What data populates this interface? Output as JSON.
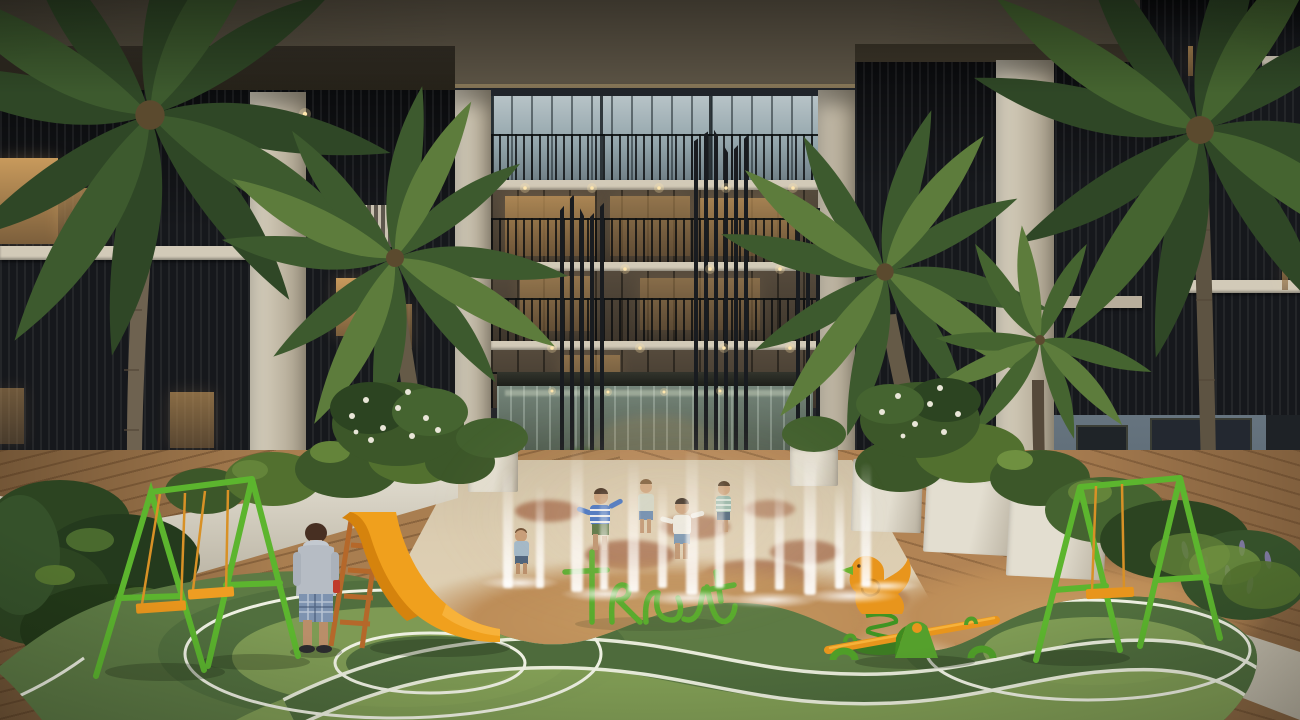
{
  "scene": {
    "description": "Dusk architectural rendering of a residential courtyard: a five-storey apartment building with glass balconies encloses a children's playground with splash-pad water jets, a glass pavilion entrance, palm trees, white planters with tropical plants, a green A-frame swing set with orange seats on each side, an orange slide with wooden ladder, a green tubular letter sculpture, an orange bird spring rider, an orange seesaw with green base, and a green rubber play surface with white curved lane lines over a timber deck.",
    "objects": [
      "apartment-building-facade",
      "glass-pavilion-entrance",
      "balcony-railings",
      "white-piers",
      "palm-trees",
      "splash-pad-water-jets",
      "children-playing",
      "child-walking",
      "swing-set-left",
      "swing-set-right",
      "orange-slide",
      "ladder",
      "letter-tube-sculpture",
      "bird-spring-rider",
      "seesaw",
      "green-play-surface",
      "white-lane-lines",
      "timber-deck",
      "white-planters",
      "tropical-plants",
      "frangipani-flowers",
      "rattan-chair",
      "downlights",
      "lit-windows"
    ],
    "people": {
      "children_in_splash_pad": 5,
      "child_walking": 1
    }
  },
  "colors": {
    "ceiling_a": "#4a4437",
    "ceiling_b": "#5d5546",
    "beam": "#7c6e52",
    "pier_light": "#ded7c5",
    "pier_shadow": "#a89e8a",
    "slab": "#d2cab8",
    "louver_bg": "#16181c",
    "louver_line": "#2e3136",
    "glass_light": "#b7c3c7",
    "glass_mid": "#93a5ab",
    "glass_dark": "#6f7f86",
    "mullion": "#30383d",
    "warm": "#c89a5c",
    "warm_dim": "#7c5f3c",
    "downlight": "#ffe6ad",
    "pavilion_top": "#23251f",
    "pavilion_glass_a": "#75857a",
    "pavilion_glass_b": "#3c4a40",
    "deck": "#a97e50",
    "deck_dark": "#7c5a36",
    "pad_a": "#d7c8ad",
    "pad_b": "#cbb79a",
    "splotch": "#9d6040",
    "ochre": "#bd8d58",
    "green_base": "#5d7a44",
    "green_shade": "#4e6b3c",
    "green_light": "#84a057",
    "line_white": "#eef0e2",
    "equip_green": "#5cb52e",
    "equip_green_dark": "#3f9422",
    "equip_orange": "#e8951c",
    "orange_highlight": "#f7b23a",
    "ladder_wood": "#b5682a",
    "foliage_a": "#2c4421",
    "foliage_b": "#3c5729",
    "foliage_c": "#52702f",
    "foliage_d": "#64843a",
    "palm_a": "#2f4726",
    "palm_b": "#3d5a2e",
    "palm_c": "#456430",
    "palm_d": "#5d7c3c",
    "trunk": "#6e6250",
    "trunk_dark": "#55493a",
    "wall_blue": "#5f6d78",
    "window_dark": "#20262b",
    "skin": "#c59a74",
    "hoodie_gray": "#b6bcc4",
    "shorts_plaid": "#7e93b0",
    "shirt_stripe_blue": "#3a6cc0",
    "flower_white": "#e9e6d8",
    "flower_purple": "#837aa8",
    "water": "#ffffff"
  }
}
